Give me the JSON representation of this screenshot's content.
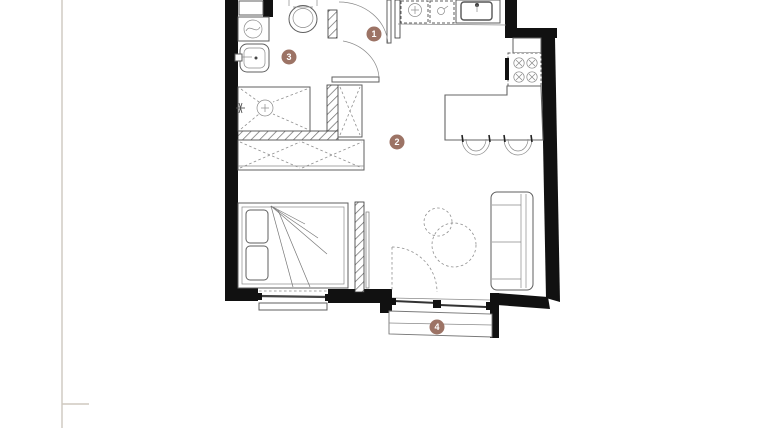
{
  "floor_plan": {
    "background": "#ffffff",
    "wall_color": "#111111",
    "line_color": "#5f5f5f",
    "marker_color": "#9c7365",
    "marker_text_color": "#ffffff",
    "markers": [
      {
        "label": "1"
      },
      {
        "label": "2"
      },
      {
        "label": "3"
      },
      {
        "label": "4"
      }
    ],
    "fixtures": [
      "entrance-door",
      "bathroom-door",
      "balcony-door",
      "washing-machine",
      "wash-basin",
      "toilet",
      "walk-in-shower",
      "tall-closet",
      "wardrobe",
      "double-bed",
      "bedroom-window",
      "dishwasher",
      "counter-appliance",
      "kitchen-sink",
      "cooktop",
      "kitchen-island",
      "bar-stool",
      "bar-stool",
      "sofa",
      "coffee-table",
      "coffee-table",
      "balcony",
      "sliding-balcony-window"
    ]
  },
  "sheet": {
    "left_rule_x": 62
  }
}
